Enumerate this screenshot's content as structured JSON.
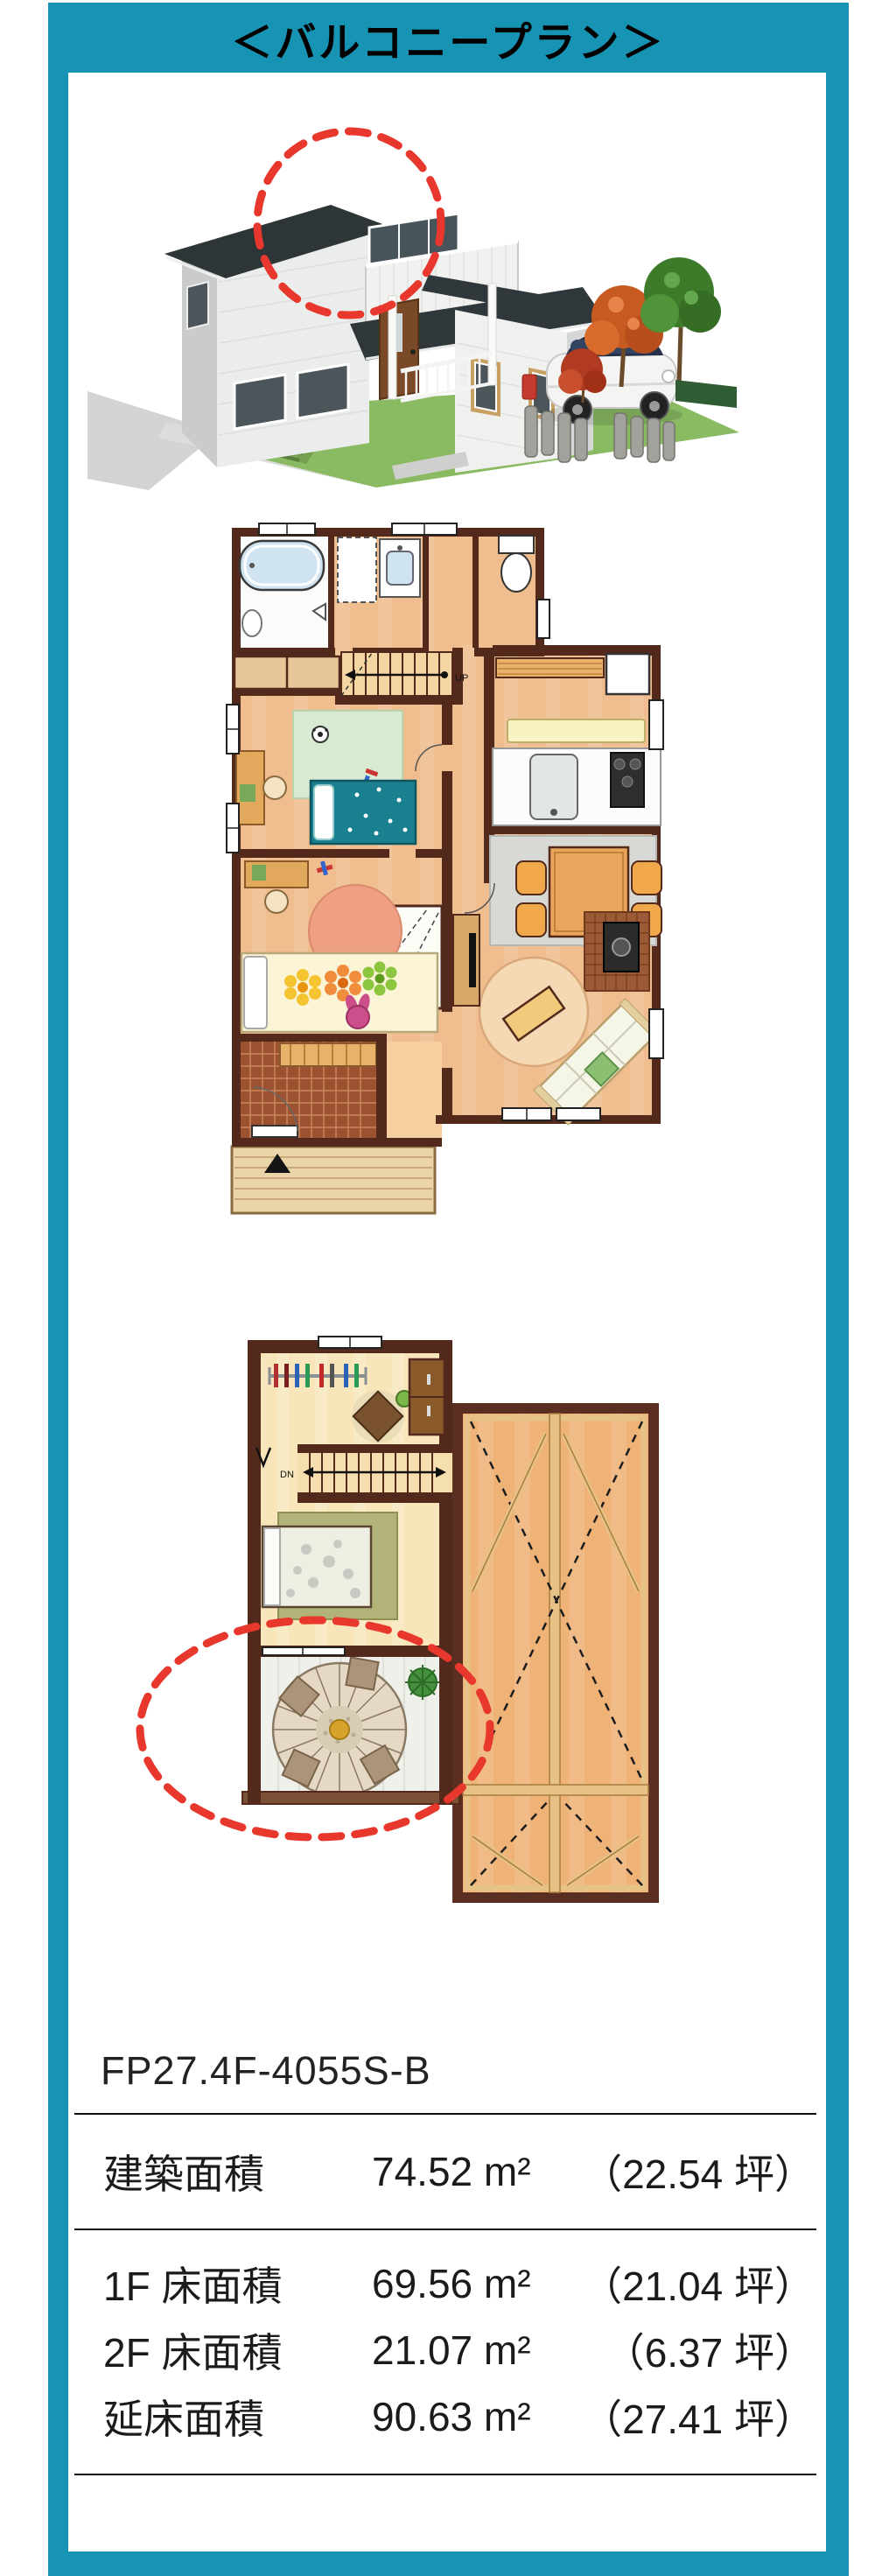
{
  "page": {
    "title": "＜バルコニープラン＞"
  },
  "colors": {
    "frame_teal": "#1794b4",
    "highlight_red": "#e8372c",
    "wall_brown": "#53291c",
    "floor_wood": "#f0bd8e"
  },
  "plans": {
    "first_floor": {
      "stairs_label": "UP"
    },
    "second_floor": {
      "stairs_label": "DN"
    }
  },
  "spec": {
    "model": "FP27.4F-4055S-B",
    "rows": [
      {
        "label": "建築面積",
        "area": "74.52 m²",
        "tsubo": "（22.54 坪）"
      },
      {
        "label": "1F 床面積",
        "area": "69.56 m²",
        "tsubo": "（21.04 坪）"
      },
      {
        "label": "2F 床面積",
        "area": "21.07 m²",
        "tsubo": "（6.37 坪）"
      },
      {
        "label": "延床面積",
        "area": "90.63 m²",
        "tsubo": "（27.41 坪）"
      }
    ]
  }
}
